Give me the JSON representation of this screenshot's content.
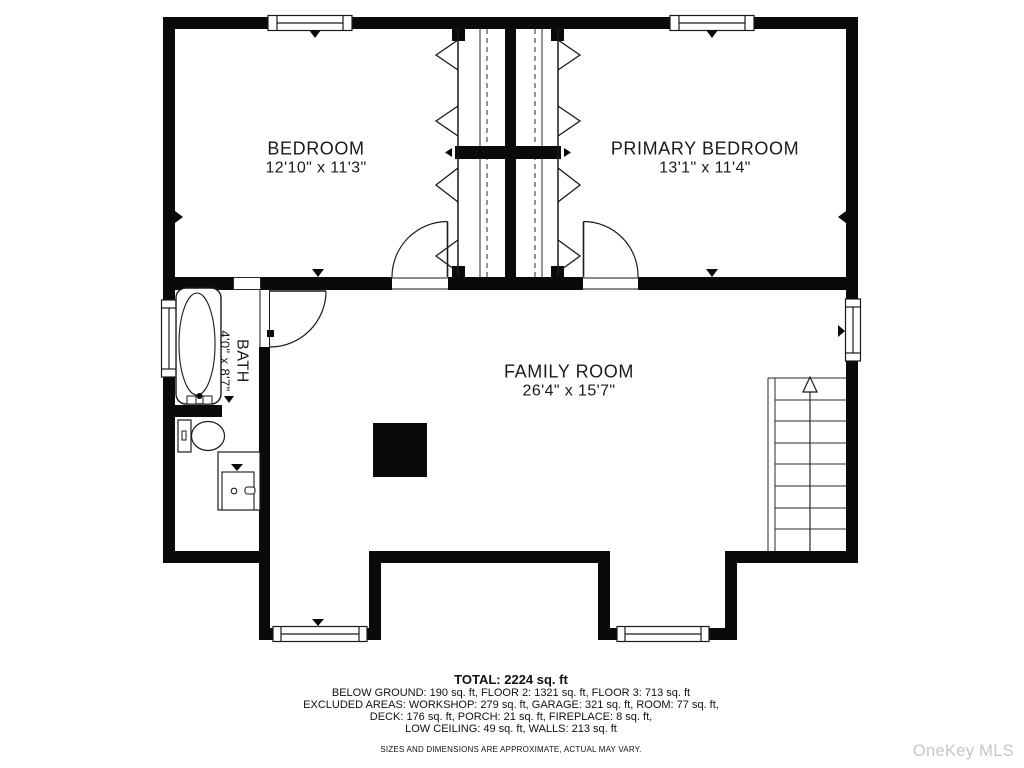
{
  "floorplan": {
    "rooms": [
      {
        "name": "BEDROOM",
        "dims": "12'10\" x 11'3\""
      },
      {
        "name": "PRIMARY BEDROOM",
        "dims": "13'1\" x 11'4\""
      },
      {
        "name": "FAMILY ROOM",
        "dims": "26'4\" x 15'7\""
      },
      {
        "name": "BATH",
        "dims": "4'0\" x 8'7\""
      }
    ],
    "summary": {
      "total": "TOTAL: 2224 sq. ft",
      "line1": "BELOW GROUND: 190 sq. ft, FLOOR 2: 1321 sq. ft, FLOOR 3: 713 sq. ft",
      "line2": "EXCLUDED AREAS: WORKSHOP: 279 sq. ft, GARAGE: 321 sq. ft, ROOM: 77 sq. ft,",
      "line3": "DECK: 176 sq. ft, PORCH: 21 sq. ft, FIREPLACE: 8 sq. ft,",
      "line4": "LOW CEILING: 49 sq. ft, WALLS: 213 sq. ft",
      "disclaimer": "SIZES AND DIMENSIONS ARE APPROXIMATE, ACTUAL MAY VARY."
    },
    "watermark": "OneKey MLS",
    "colors": {
      "walls": "#0a0a0a",
      "lines": "#2a2a2a",
      "text": "#1a1a1a",
      "watermark": "#c6c6c8"
    }
  }
}
